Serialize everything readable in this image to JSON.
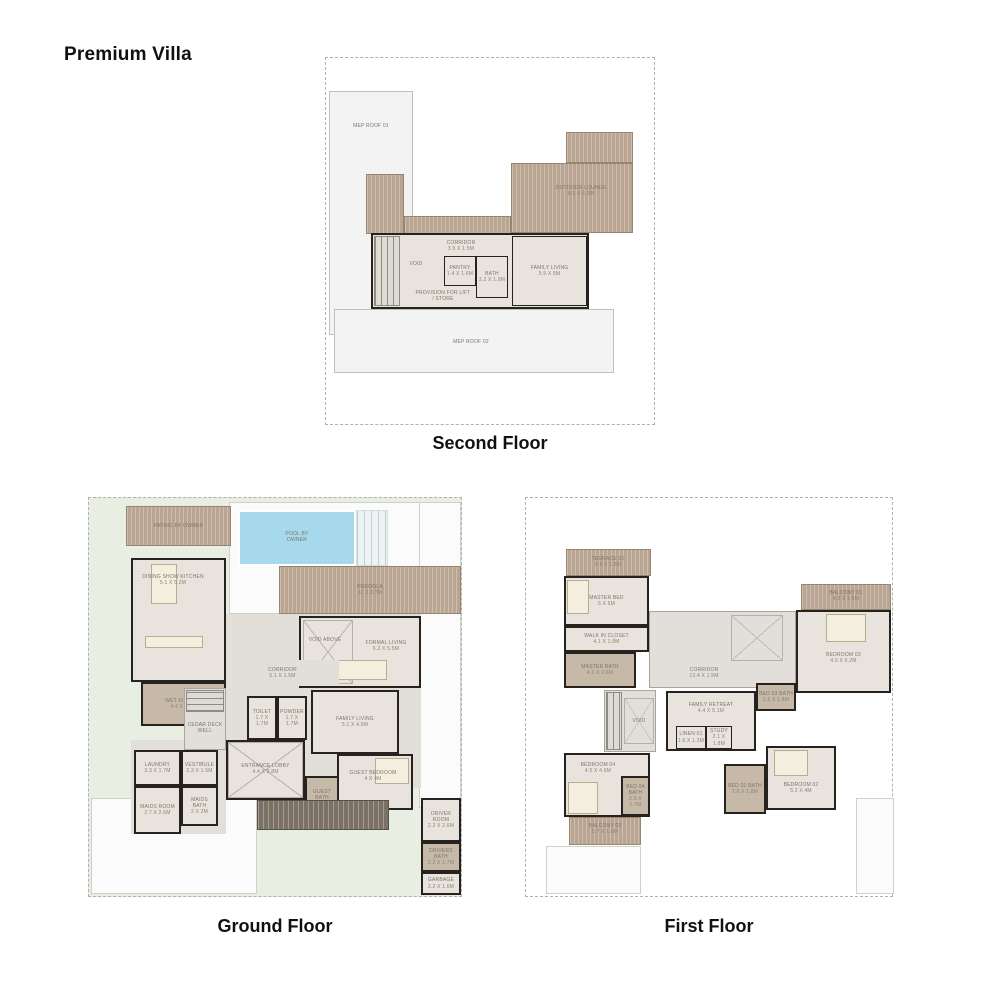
{
  "page": {
    "title": "Premium Villa"
  },
  "colors": {
    "wall": "#26231f",
    "room_floor": "#e8e4dd",
    "bath_floor": "#c6b9a8",
    "deck_wood": "#b9a591",
    "roof_gray": "#f2f3f2",
    "pool_blue": "#a7d9ed",
    "landscape_green": "#e9eee2",
    "label_text": "#7d756a",
    "title_text": "#111111"
  },
  "floors": [
    {
      "id": "second-floor",
      "caption": "Second Floor",
      "shapes": [
        {
          "name": "mep-roof-01",
          "type": "roof",
          "x": 3,
          "y": 33,
          "w": 84,
          "h": 244
        },
        {
          "name": "mep-roof-01-label",
          "type": "label",
          "x": 8,
          "y": 62,
          "w": 74,
          "h": 12,
          "label": "MEP ROOF 01"
        },
        {
          "name": "deck-side",
          "type": "deck",
          "x": 40,
          "y": 116,
          "w": 38,
          "h": 60
        },
        {
          "name": "deck-strip",
          "type": "deck",
          "x": 78,
          "y": 158,
          "w": 107,
          "h": 18
        },
        {
          "name": "outdoor-lounge-upper",
          "type": "deck",
          "x": 240,
          "y": 74,
          "w": 67,
          "h": 31
        },
        {
          "name": "outdoor-lounge",
          "type": "deck",
          "x": 185,
          "y": 105,
          "w": 122,
          "h": 70
        },
        {
          "name": "outdoor-lounge-label",
          "type": "label",
          "x": 208,
          "y": 124,
          "w": 94,
          "h": 18,
          "label": "OUTDOOR LOUNGE",
          "dims": "8.5 X 6.2M"
        },
        {
          "name": "rooms-block",
          "type": "room",
          "x": 45,
          "y": 175,
          "w": 218,
          "h": 76
        },
        {
          "name": "stair-treads",
          "type": "stair-v",
          "x": 48,
          "y": 178,
          "w": 26,
          "h": 70
        },
        {
          "name": "void-label",
          "type": "label",
          "x": 74,
          "y": 200,
          "w": 32,
          "h": 12,
          "label": "VOID"
        },
        {
          "name": "corridor-label",
          "type": "label",
          "x": 105,
          "y": 180,
          "w": 60,
          "h": 16,
          "label": "CORRIDOR",
          "dims": "3.9 X 1.5M"
        },
        {
          "name": "pantry",
          "type": "room-i",
          "x": 118,
          "y": 198,
          "w": 32,
          "h": 30,
          "label": "PANTRY",
          "dims": "1.4 X 1.6M"
        },
        {
          "name": "bath",
          "type": "room-i",
          "x": 150,
          "y": 198,
          "w": 32,
          "h": 42,
          "label": "BATH",
          "dims": "3.2 X 1.9M"
        },
        {
          "name": "family-living",
          "type": "room-i",
          "x": 186,
          "y": 178,
          "w": 75,
          "h": 70,
          "label": "FAMILY LIVING",
          "dims": "5.9 X 5M"
        },
        {
          "name": "provision-label",
          "type": "label",
          "x": 88,
          "y": 228,
          "w": 58,
          "h": 20,
          "label": "PROVISION FOR LIFT / STORE"
        },
        {
          "name": "mep-roof-02",
          "type": "roof",
          "x": 8,
          "y": 251,
          "w": 280,
          "h": 64
        },
        {
          "name": "mep-roof-02-label",
          "type": "label",
          "x": 105,
          "y": 278,
          "w": 80,
          "h": 12,
          "label": "MEP ROOF 02"
        }
      ]
    },
    {
      "id": "ground-floor",
      "caption": "Ground Floor",
      "shapes": [
        {
          "name": "paving-top",
          "type": "white",
          "x": 140,
          "y": 4,
          "w": 232,
          "h": 112
        },
        {
          "name": "paving-right",
          "type": "white",
          "x": 330,
          "y": 4,
          "w": 42,
          "h": 306
        },
        {
          "name": "garage-paving",
          "type": "white",
          "x": 2,
          "y": 300,
          "w": 166,
          "h": 96
        },
        {
          "name": "floor-slab-center",
          "type": "area",
          "x": 137,
          "y": 116,
          "w": 195,
          "h": 174
        },
        {
          "name": "floor-slab-service",
          "type": "area",
          "x": 42,
          "y": 242,
          "w": 95,
          "h": 94
        },
        {
          "name": "pool",
          "type": "pool",
          "x": 149,
          "y": 12,
          "w": 118,
          "h": 56
        },
        {
          "name": "pool-steps",
          "type": "steps",
          "x": 267,
          "y": 12,
          "w": 32,
          "h": 56
        },
        {
          "name": "pool-label",
          "type": "label",
          "x": 186,
          "y": 28,
          "w": 44,
          "h": 22,
          "label": "POOL BY OWNER"
        },
        {
          "name": "paving-by-owner",
          "type": "deck",
          "x": 37,
          "y": 8,
          "w": 105,
          "h": 40,
          "label": "PAVING BY OWNER"
        },
        {
          "name": "pergola",
          "type": "deck",
          "x": 190,
          "y": 68,
          "w": 182,
          "h": 48,
          "label": "PERGOLA",
          "dims": "11 X 3.7M"
        },
        {
          "name": "dining-show-kitchen",
          "type": "room",
          "x": 42,
          "y": 60,
          "w": 95,
          "h": 124
        },
        {
          "name": "dining-table",
          "type": "furn",
          "x": 62,
          "y": 66,
          "w": 26,
          "h": 40
        },
        {
          "name": "kitchen-island",
          "type": "furn",
          "x": 56,
          "y": 138,
          "w": 58,
          "h": 12
        },
        {
          "name": "dining-kitchen-label",
          "type": "label",
          "x": 50,
          "y": 70,
          "w": 68,
          "h": 24,
          "label": "DINING SHOW KITCHEN",
          "dims": "5.1 X 5.2M"
        },
        {
          "name": "wet-kitchen",
          "type": "room-dark",
          "x": 52,
          "y": 184,
          "w": 85,
          "h": 44,
          "label": "WET KITCHEN",
          "dims": "4.4 X 3.6M"
        },
        {
          "name": "formal-living",
          "type": "room",
          "x": 210,
          "y": 118,
          "w": 122,
          "h": 72
        },
        {
          "name": "void-above-hatch",
          "type": "hatch",
          "x": 214,
          "y": 122,
          "w": 50,
          "h": 64
        },
        {
          "name": "void-above-label",
          "type": "label",
          "x": 214,
          "y": 134,
          "w": 44,
          "h": 16,
          "label": "VOID ABOVE"
        },
        {
          "name": "formal-living-label",
          "type": "label",
          "x": 268,
          "y": 138,
          "w": 58,
          "h": 20,
          "label": "FORMAL LIVING",
          "dims": "6.2 X 5.5M"
        },
        {
          "name": "formal-sofa",
          "type": "furn",
          "x": 240,
          "y": 162,
          "w": 58,
          "h": 20
        },
        {
          "name": "corridor",
          "type": "area",
          "x": 137,
          "y": 162,
          "w": 113,
          "h": 26,
          "label": "CORRIDOR",
          "dims": "5.1 X 1.5M"
        },
        {
          "name": "stair-court",
          "type": "area-b",
          "x": 95,
          "y": 190,
          "w": 42,
          "h": 62
        },
        {
          "name": "stair-treads",
          "type": "stair-h",
          "x": 97,
          "y": 192,
          "w": 38,
          "h": 22
        },
        {
          "name": "cedar-deck-label",
          "type": "label",
          "x": 96,
          "y": 220,
          "w": 40,
          "h": 20,
          "label": "CEDAR DECK WELL"
        },
        {
          "name": "toilet",
          "type": "room",
          "x": 158,
          "y": 198,
          "w": 30,
          "h": 44,
          "label": "TOILET",
          "dims": "1.7 X 1.7M"
        },
        {
          "name": "powder",
          "type": "room",
          "x": 188,
          "y": 198,
          "w": 30,
          "h": 44,
          "label": "POWDER",
          "dims": "1.7 X 1.7M"
        },
        {
          "name": "family-living",
          "type": "room",
          "x": 222,
          "y": 192,
          "w": 88,
          "h": 64,
          "label": "FAMILY LIVING",
          "dims": "5.1 X 4.5M"
        },
        {
          "name": "entrance-lobby",
          "type": "room",
          "x": 137,
          "y": 242,
          "w": 79,
          "h": 60
        },
        {
          "name": "lobby-hatch",
          "type": "hatch",
          "x": 139,
          "y": 244,
          "w": 75,
          "h": 56
        },
        {
          "name": "lobby-label",
          "type": "label",
          "x": 140,
          "y": 260,
          "w": 73,
          "h": 22,
          "label": "ENTRANCE LOBBY",
          "dims": "4.4 X 3.8M"
        },
        {
          "name": "laundry",
          "type": "room",
          "x": 45,
          "y": 252,
          "w": 47,
          "h": 36,
          "label": "LAUNDRY",
          "dims": "3.3 X 1.7M"
        },
        {
          "name": "vestibule",
          "type": "room",
          "x": 92,
          "y": 252,
          "w": 37,
          "h": 36,
          "label": "VESTIBULE",
          "dims": "2.3 X 1.5M"
        },
        {
          "name": "maids-room",
          "type": "room",
          "x": 45,
          "y": 288,
          "w": 47,
          "h": 48,
          "label": "MAIDS ROOM",
          "dims": "2.7 X 2.6M"
        },
        {
          "name": "maids-bath",
          "type": "room",
          "x": 92,
          "y": 288,
          "w": 37,
          "h": 40,
          "label": "MAIDS BATH",
          "dims": "2 X 2M"
        },
        {
          "name": "guest-bedroom",
          "type": "room",
          "x": 248,
          "y": 256,
          "w": 76,
          "h": 56
        },
        {
          "name": "guest-bed",
          "type": "furn",
          "x": 286,
          "y": 260,
          "w": 34,
          "h": 26
        },
        {
          "name": "guest-bedroom-label",
          "type": "label",
          "x": 252,
          "y": 268,
          "w": 64,
          "h": 20,
          "label": "GUEST BEDROOM",
          "dims": "4 X 4M"
        },
        {
          "name": "guest-bath",
          "type": "room-dark",
          "x": 216,
          "y": 278,
          "w": 34,
          "h": 44,
          "label": "GUEST BATH",
          "dims": "1.6 X 2.5M"
        },
        {
          "name": "driver-room",
          "type": "room",
          "x": 332,
          "y": 300,
          "w": 40,
          "h": 44,
          "label": "DRIVER ROOM",
          "dims": "2.2 X 2.6M"
        },
        {
          "name": "drivers-bath",
          "type": "room-dark",
          "x": 332,
          "y": 344,
          "w": 40,
          "h": 30,
          "label": "DRIVERS BATH",
          "dims": "2.2 X 1.7M"
        },
        {
          "name": "garbage",
          "type": "room",
          "x": 332,
          "y": 374,
          "w": 40,
          "h": 23,
          "label": "GARBAGE",
          "dims": "2.2 X 1.6M"
        },
        {
          "name": "entrance-walk",
          "type": "walk",
          "x": 168,
          "y": 302,
          "w": 132,
          "h": 30
        }
      ]
    },
    {
      "id": "first-floor",
      "caption": "First Floor",
      "shapes": [
        {
          "name": "terrace-01",
          "type": "deck",
          "x": 40,
          "y": 51,
          "w": 85,
          "h": 27
        },
        {
          "name": "terrace-01-label",
          "type": "label",
          "x": 52,
          "y": 54,
          "w": 60,
          "h": 20,
          "label": "TERRACE 01",
          "dims": "5.9 X 1.8M"
        },
        {
          "name": "master-bed",
          "type": "room",
          "x": 38,
          "y": 78,
          "w": 85,
          "h": 50,
          "label": "MASTER BED",
          "dims": "6 X 5M"
        },
        {
          "name": "master-bed-furn",
          "type": "furn",
          "x": 41,
          "y": 82,
          "w": 22,
          "h": 34
        },
        {
          "name": "walk-in-closet",
          "type": "room",
          "x": 38,
          "y": 128,
          "w": 85,
          "h": 26,
          "label": "WALK IN CLOSET",
          "dims": "4.1 X 1.8M"
        },
        {
          "name": "master-bath",
          "type": "room-dark",
          "x": 38,
          "y": 154,
          "w": 72,
          "h": 36,
          "label": "MASTER BATH",
          "dims": "4.1 X 2.6M"
        },
        {
          "name": "hall",
          "type": "area-b",
          "x": 123,
          "y": 113,
          "w": 147,
          "h": 77
        },
        {
          "name": "void-above",
          "type": "hatch",
          "x": 205,
          "y": 117,
          "w": 52,
          "h": 46
        },
        {
          "name": "corridor-label",
          "type": "label",
          "x": 138,
          "y": 167,
          "w": 80,
          "h": 16,
          "label": "CORRIDOR",
          "dims": "13.4 X 1.5M"
        },
        {
          "name": "stairwell",
          "type": "area-b",
          "x": 78,
          "y": 192,
          "w": 52,
          "h": 62
        },
        {
          "name": "stair-treads",
          "type": "stair-v",
          "x": 80,
          "y": 194,
          "w": 16,
          "h": 58
        },
        {
          "name": "stair-void",
          "type": "hatch",
          "x": 98,
          "y": 200,
          "w": 30,
          "h": 46,
          "label": "VOID"
        },
        {
          "name": "family-retreat",
          "type": "room",
          "x": 140,
          "y": 193,
          "w": 90,
          "h": 60
        },
        {
          "name": "family-retreat-label",
          "type": "label",
          "x": 150,
          "y": 200,
          "w": 70,
          "h": 20,
          "label": "FAMILY RETREAT",
          "dims": "4.4 X 5.1M"
        },
        {
          "name": "linen-01",
          "type": "room-i",
          "x": 150,
          "y": 228,
          "w": 30,
          "h": 23,
          "label": "LINEN 01",
          "dims": "1.6 X 1.2M"
        },
        {
          "name": "study",
          "type": "room-i",
          "x": 180,
          "y": 228,
          "w": 26,
          "h": 23,
          "label": "STUDY",
          "dims": "2.1 X 1.8M"
        },
        {
          "name": "balcony-01",
          "type": "deck",
          "x": 275,
          "y": 86,
          "w": 90,
          "h": 26
        },
        {
          "name": "balcony-01-label",
          "type": "label",
          "x": 292,
          "y": 88,
          "w": 56,
          "h": 20,
          "label": "BALCONY 01",
          "dims": "4.5 X 1.6M"
        },
        {
          "name": "bedroom-03",
          "type": "room",
          "x": 270,
          "y": 112,
          "w": 95,
          "h": 83
        },
        {
          "name": "bedroom-03-bed",
          "type": "furn",
          "x": 300,
          "y": 116,
          "w": 40,
          "h": 28
        },
        {
          "name": "bedroom-03-label",
          "type": "label",
          "x": 285,
          "y": 150,
          "w": 65,
          "h": 20,
          "label": "BEDROOM 03",
          "dims": "4.5 X 5.2M"
        },
        {
          "name": "bed-03-bath",
          "type": "room-dark",
          "x": 230,
          "y": 185,
          "w": 40,
          "h": 28,
          "label": "BED 03 BATH",
          "dims": "2.6 X 1.8M"
        },
        {
          "name": "bedroom-02",
          "type": "room",
          "x": 240,
          "y": 248,
          "w": 70,
          "h": 64
        },
        {
          "name": "bedroom-02-bed",
          "type": "furn",
          "x": 248,
          "y": 252,
          "w": 34,
          "h": 26
        },
        {
          "name": "bedroom-02-label",
          "type": "label",
          "x": 245,
          "y": 280,
          "w": 60,
          "h": 20,
          "label": "BEDROOM 02",
          "dims": "5.2 X 4M"
        },
        {
          "name": "bed-02-bath",
          "type": "room-dark",
          "x": 198,
          "y": 266,
          "w": 42,
          "h": 50,
          "label": "BED 02 BATH",
          "dims": "2.6 X 1.8M"
        },
        {
          "name": "bedroom-04",
          "type": "room",
          "x": 38,
          "y": 255,
          "w": 86,
          "h": 64
        },
        {
          "name": "bedroom-04-bed",
          "type": "furn",
          "x": 42,
          "y": 284,
          "w": 30,
          "h": 32
        },
        {
          "name": "bedroom-04-label",
          "type": "label",
          "x": 44,
          "y": 260,
          "w": 56,
          "h": 20,
          "label": "BEDROOM 04",
          "dims": "4.5 X 4.6M"
        },
        {
          "name": "bed-04-bath",
          "type": "room-dark",
          "x": 95,
          "y": 278,
          "w": 29,
          "h": 40,
          "label": "BED 04 BATH",
          "dims": "2.6 X 1.7M"
        },
        {
          "name": "balcony-02",
          "type": "deck",
          "x": 43,
          "y": 319,
          "w": 72,
          "h": 28
        },
        {
          "name": "balcony-02-label",
          "type": "label",
          "x": 50,
          "y": 321,
          "w": 58,
          "h": 20,
          "label": "BALCONY 02",
          "dims": "5.7 X 1.6M"
        },
        {
          "name": "patio-right",
          "type": "white",
          "x": 330,
          "y": 300,
          "w": 38,
          "h": 96
        },
        {
          "name": "patio-left",
          "type": "white",
          "x": 20,
          "y": 348,
          "w": 95,
          "h": 48
        }
      ]
    }
  ]
}
